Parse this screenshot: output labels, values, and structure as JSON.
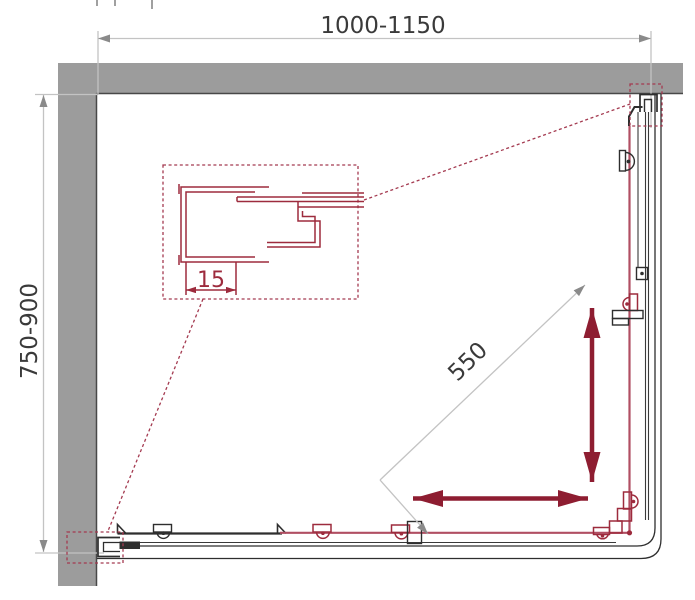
{
  "diagram": {
    "dims": {
      "width_label": "1000-1150",
      "depth_label": "750-900",
      "entry_label": "550",
      "profile_label": "15"
    },
    "colors": {
      "wall_gray": "#9c9c9c",
      "drawing_black": "#2e2e2e",
      "detail_red": "#9d2b3d",
      "door_red": "#b14f63",
      "arrow_red": "#8e1d31",
      "dimension_gray": "#c3c3c3",
      "dimension_text": "#3a3a3a"
    }
  }
}
